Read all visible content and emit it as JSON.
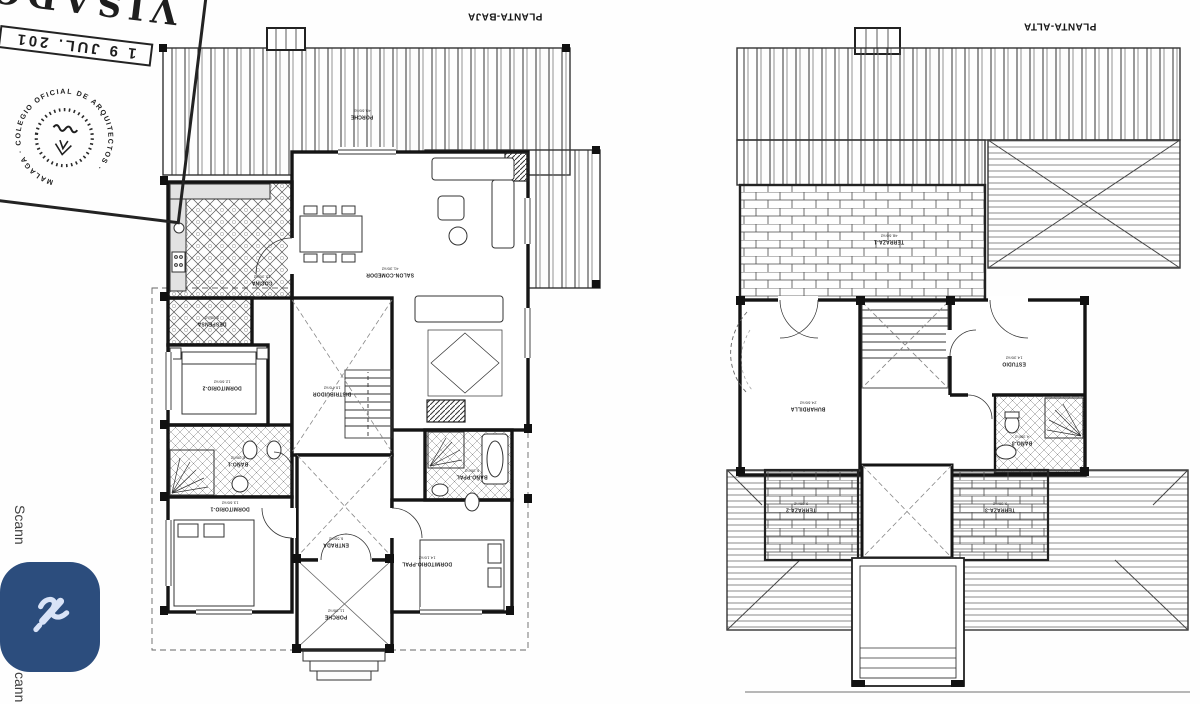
{
  "page": {
    "background": "#fefefe"
  },
  "titles": {
    "baja": "PLANTA-BAJA",
    "alta": "PLANTA-ALTA"
  },
  "stamp": {
    "visado": "VISADO",
    "date": "1 9 JUL. 201",
    "ring": "MALAGA · COLEGIO OFICIAL DE ARQUITECTOS ·",
    "emblem": "laurel-wreath-emblem"
  },
  "watermark": {
    "top": "Scann",
    "bottom": "cann"
  },
  "fab": {
    "color": "#2c4d7d",
    "icon_color": "#d9e3f7",
    "icon": "signature-pen-icon"
  },
  "plans": {
    "baja": {
      "title": "PLANTA-BAJA",
      "rooms": [
        {
          "name": "PORCHE",
          "area": "45.60m2"
        },
        {
          "name": "SALON-COMEDOR",
          "area": "41.30m2"
        },
        {
          "name": "COCINA",
          "area": "15.30m2"
        },
        {
          "name": "DESPENSA",
          "area": "3.30m2"
        },
        {
          "name": "DORMITORIO-2",
          "area": "12.60m2"
        },
        {
          "name": "DISTRIBUIDOR",
          "area": "10.70m2"
        },
        {
          "name": "BAÑO-1",
          "area": "6.30m2"
        },
        {
          "name": "DORMITORIO-1",
          "area": "13.60m2"
        },
        {
          "name": "ENTRADA",
          "area": "6.50m2"
        },
        {
          "name": "DORMITORIO-PPAL",
          "area": "14.10m2"
        },
        {
          "name": "BAÑO-PPAL",
          "area": "6.30m2"
        },
        {
          "name": "PORCHE",
          "area": "11.30m2"
        }
      ]
    },
    "alta": {
      "title": "PLANTA-ALTA",
      "rooms": [
        {
          "name": "TERRAZA-1",
          "area": "48.60m2"
        },
        {
          "name": "BUHARDILLA",
          "area": "24.60m2"
        },
        {
          "name": "ESTUDIO",
          "area": "14.30m2"
        },
        {
          "name": "BAÑO-3",
          "area": "4.30m2"
        },
        {
          "name": "TERRAZA-2",
          "area": "9.30m2"
        },
        {
          "name": "TERRAZA-3",
          "area": "9.30m2"
        }
      ]
    }
  }
}
